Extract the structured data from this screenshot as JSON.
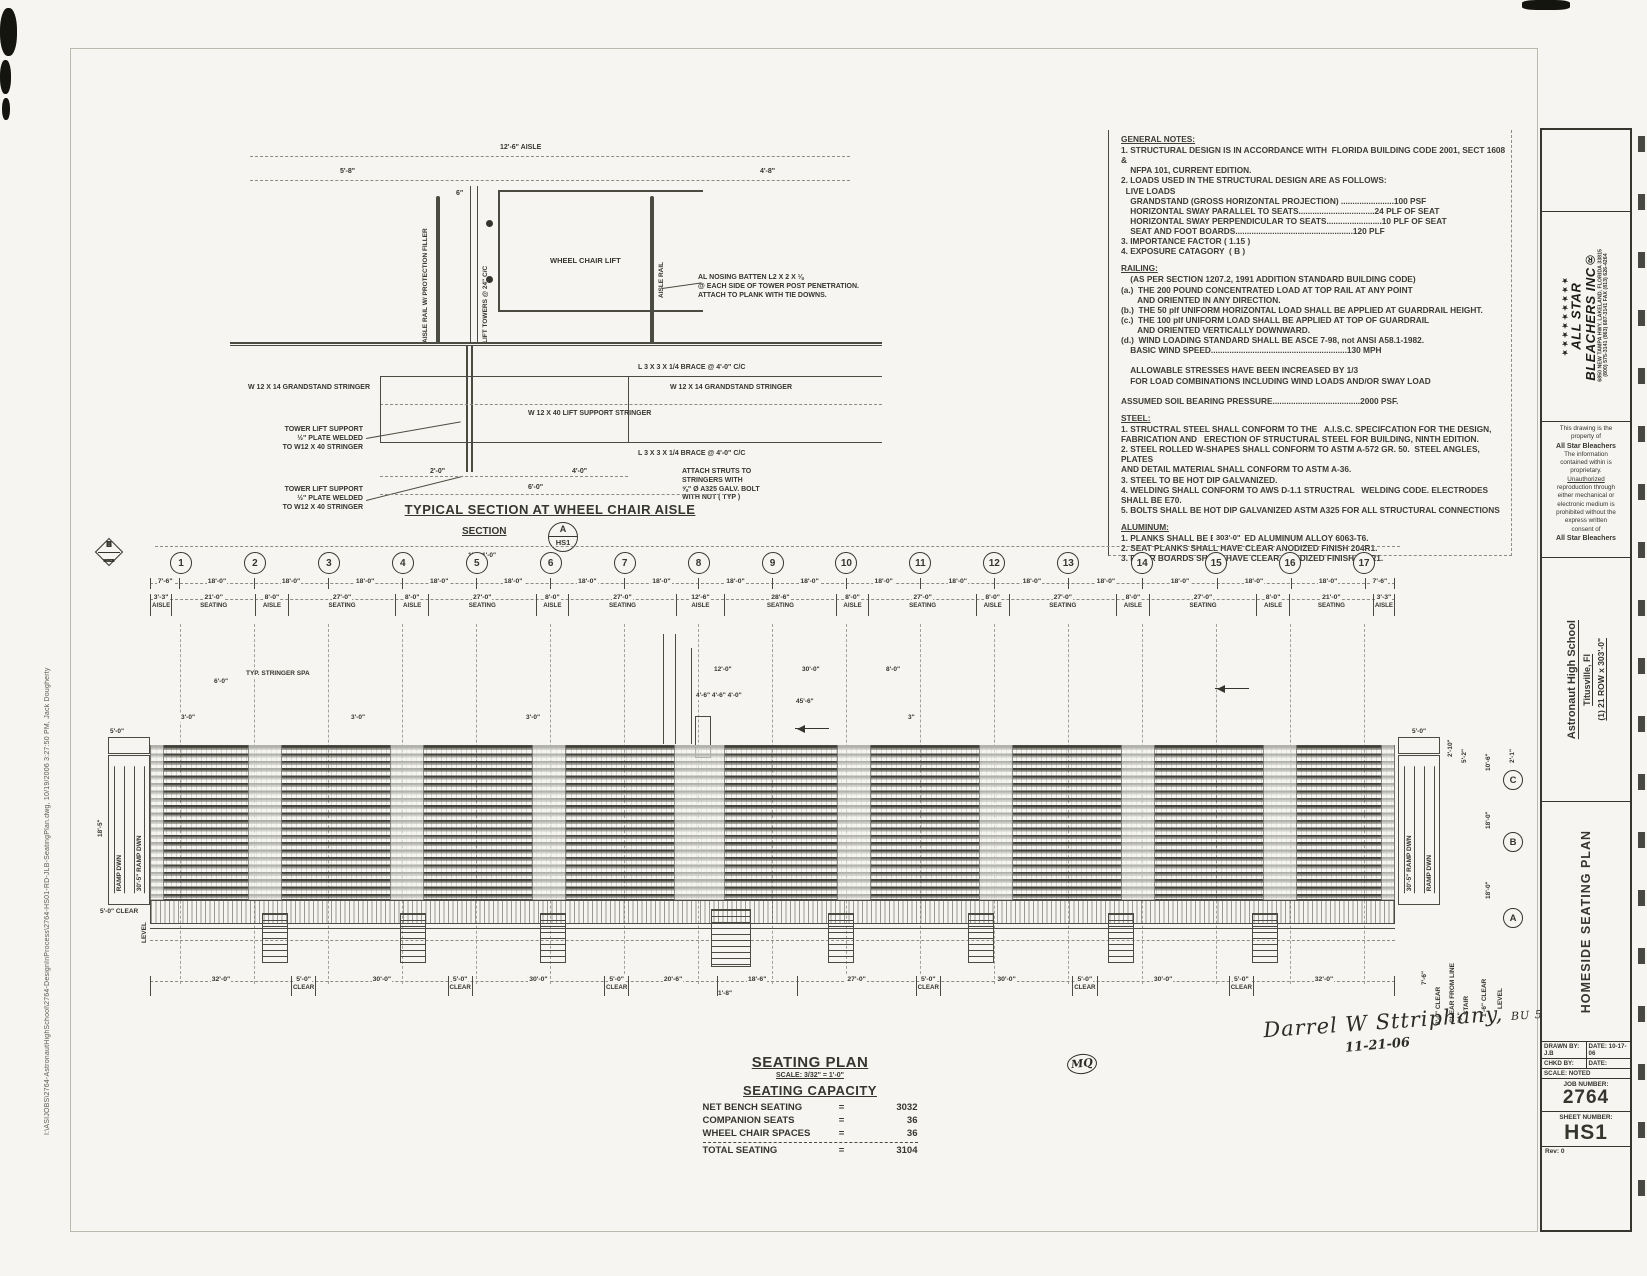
{
  "filepath": "I:\\ASIJOBS\\2764-AstronautHighSchool\\2764-DesignInProcess\\2764-HS01-RD-JLB-SeatingPlan.dwg, 10/19/2006 3:27:50 PM, Jack Dougherty",
  "notes": {
    "sections": [
      {
        "heading": "GENERAL NOTES:",
        "body": "1. STRUCTURAL DESIGN IS IN ACCORDANCE WITH  FLORIDA BUILDING CODE 2001, SECT 1608 &\n    NFPA 101, CURRENT EDITION.\n2. LOADS USED IN THE STRUCTURAL DESIGN ARE AS FOLLOWS:\n  LIVE LOADS\n    GRANDSTAND (GROSS HORIZONTAL PROJECTION) .......................100 PSF\n    HORIZONTAL SWAY PARALLEL TO SEATS.................................24 PLF OF SEAT\n    HORIZONTAL SWAY PERPENDICULAR TO SEATS........................10 PLF OF SEAT\n    SEAT AND FOOT BOARDS...................................................120 PLF\n3. IMPORTANCE FACTOR ( 1.15 )\n4. EXPOSURE CATAGORY  ( B )"
      },
      {
        "heading": "RAILING:",
        "body": "    (AS PER SECTION 1207.2, 1991 ADDITION STANDARD BUILDING CODE)\n(a.)  THE 200 POUND CONCENTRATED LOAD AT TOP RAIL AT ANY POINT\n       AND ORIENTED IN ANY DIRECTION.\n(b.)  THE 50 plf UNIFORM HORIZONTAL LOAD SHALL BE APPLIED AT GUARDRAIL HEIGHT.\n(c.)  THE 100 plf UNIFORM LOAD SHALL BE APPLIED AT TOP OF GUARDRAIL\n       AND ORIENTED VERTICALLY DOWNWARD.\n(d.)  WIND LOADING STANDARD SHALL BE ASCE 7-98, not ANSI A58.1-1982.\n    BASIC WIND SPEED...........................................................130 MPH\n\n    ALLOWABLE STRESSES HAVE BEEN INCREASED BY 1/3\n    FOR LOAD COMBINATIONS INCLUDING WIND LOADS AND/OR SWAY LOAD\n\nASSUMED SOIL BEARING PRESSURE......................................2000 PSF."
      },
      {
        "heading": "STEEL:",
        "body": "1. STRUCTRAL STEEL SHALL CONFORM TO THE   A.I.S.C. SPECIFCATION FOR THE DESIGN,\nFABRICATION AND   ERECTION OF STRUCTURAL STEEL FOR BUILDING, NINTH EDITION.\n2. STEEL ROLLED W-SHAPES SHALL CONFORM TO ASTM A-572 GR. 50.  STEEL ANGLES, PLATES\nAND DETAIL MATERIAL SHALL CONFORM TO ASTM A-36.\n3. STEEL TO BE HOT DIP GALVANIZED.\n4. WELDING SHALL CONFORM TO AWS D-1.1 STRUCTRAL   WELDING CODE. ELECTRODES SHALL BE E70.\n5. BOLTS SHALL BE HOT DIP GALVANIZED ASTM A325 FOR ALL STRUCTURAL CONNECTIONS"
      },
      {
        "heading": "ALUMINUM:",
        "body": "1. PLANKS SHALL BE EXTRUDED ALUMINUM ALLOY 6063-T6.\n2. SEAT PLANKS SHALL HAVE CLEAR ANODIZED FINISH 204R1.\n3. RISER BOARDS SHALL HAVE CLEAR ANODIZED FINISH 204R1."
      }
    ]
  },
  "detail": {
    "dim_aisle": "12'-6\" AISLE",
    "dim_left": "5'-8\"",
    "dim_right": "4'-8\"",
    "dim_small": "6\"",
    "rail_left": "AISLE RAIL W/ PROTECTION FILLER",
    "towers": "LIFT TOWERS  @ 24\" C/C",
    "rail_right": "AISLE RAIL",
    "lift": "WHEEL CHAIR LIFT",
    "nosing": "AL NOSING BATTEN L2 X 2 X ⅛\n@ EACH SIDE OF TOWER POST PENETRATION.\nATTACH TO PLANK WITH TIE DOWNS.",
    "grandstand_left": "W 12 X 14 GRANDSTAND STRINGER",
    "grandstand_right": "W 12 X 14 GRANDSTAND STRINGER",
    "brace_upper": "L 3 X 3 X 1/4  BRACE @ 4'-0\" C/C",
    "brace_lower": "L 3 X 3 X 1/4  BRACE @ 4'-0\" C/C",
    "lift_stringer": "W 12 X 40 LIFT SUPPORT STRINGER",
    "tower_support_1": "TOWER LIFT SUPPORT\n½\" PLATE WELDED\nTO W12 X 40 STRINGER",
    "tower_support_2": "TOWER LIFT SUPPORT\n½\" PLATE WELDED\nTO W12 X 40 STRINGER",
    "struts": "ATTACH STRUTS TO\nSTRINGERS WITH\n⅝\" Ø A325 GALV. BOLT\nWITH NUT ( TYP )",
    "dim_2": "2'-0\"",
    "dim_4": "4'-0\"",
    "dim_6": "6'-0\"",
    "title": "TYPICAL SECTION AT WHEEL CHAIR AISLE",
    "section_label": "SECTION",
    "bubble_top": "A",
    "bubble_bottom": "HS1",
    "scale": "1\" = 1'-0\""
  },
  "plan": {
    "overall_dim": "303'-0\"",
    "grids": [
      "1",
      "2",
      "3",
      "4",
      "5",
      "6",
      "7",
      "8",
      "9",
      "10",
      "11",
      "12",
      "13",
      "14",
      "15",
      "16",
      "17"
    ],
    "grid_dims": [
      "7'-6\"",
      "18'-0\"",
      "18'-0\"",
      "18'-0\"",
      "18'-0\"",
      "18'-0\"",
      "18'-0\"",
      "18'-0\"",
      "18'-0\"",
      "18'-0\"",
      "18'-0\"",
      "18'-0\"",
      "18'-0\"",
      "18'-0\"",
      "18'-0\"",
      "18'-0\"",
      "18'-0\"",
      "7'-6\""
    ],
    "bays": [
      {
        "dim": "3'-3\"",
        "label": "AISLE"
      },
      {
        "dim": "21'-0\"",
        "label": "SEATING"
      },
      {
        "dim": "8'-0\"",
        "label": "AISLE"
      },
      {
        "dim": "27'-0\"",
        "label": "SEATING"
      },
      {
        "dim": "8'-0\"",
        "label": "AISLE"
      },
      {
        "dim": "27'-0\"",
        "label": "SEATING"
      },
      {
        "dim": "8'-0\"",
        "label": "AISLE"
      },
      {
        "dim": "27'-0\"",
        "label": "SEATING"
      },
      {
        "dim": "12'-6\"",
        "label": "AISLE"
      },
      {
        "dim": "28'-6\"",
        "label": "SEATING"
      },
      {
        "dim": "8'-0\"",
        "label": "AISLE"
      },
      {
        "dim": "27'-0\"",
        "label": "SEATING"
      },
      {
        "dim": "8'-0\"",
        "label": "AISLE"
      },
      {
        "dim": "27'-0\"",
        "label": "SEATING"
      },
      {
        "dim": "8'-0\"",
        "label": "AISLE"
      },
      {
        "dim": "27'-0\"",
        "label": "SEATING"
      },
      {
        "dim": "8'-0\"",
        "label": "AISLE"
      },
      {
        "dim": "21'-0\"",
        "label": "SEATING"
      },
      {
        "dim": "3'-3\"",
        "label": "AISLE"
      }
    ],
    "bottom_dims": [
      {
        "dim": "32'-0\"",
        "label": ""
      },
      {
        "dim": "5'-0\"",
        "label": "CLEAR"
      },
      {
        "dim": "30'-0\"",
        "label": ""
      },
      {
        "dim": "5'-0\"",
        "label": "CLEAR"
      },
      {
        "dim": "30'-0\"",
        "label": ""
      },
      {
        "dim": "5'-0\"",
        "label": "CLEAR"
      },
      {
        "dim": "20'-6\"",
        "label": ""
      },
      {
        "dim": "18'-6\"",
        "label": ""
      },
      {
        "dim": "27'-0\"",
        "label": ""
      },
      {
        "dim": "5'-0\"",
        "label": "CLEAR"
      },
      {
        "dim": "30'-0\"",
        "label": ""
      },
      {
        "dim": "5'-0\"",
        "label": "CLEAR"
      },
      {
        "dim": "30'-0\"",
        "label": ""
      },
      {
        "dim": "5'-0\"",
        "label": "CLEAR"
      },
      {
        "dim": "32'-0\"",
        "label": ""
      }
    ],
    "markers": [
      {
        "letter": "E",
        "sheet": "HS11"
      },
      {
        "letter": "D",
        "sheet": "HS10"
      },
      {
        "letter": "C",
        "sheet": "HS3"
      },
      {
        "letter": "B",
        "sheet": "HS1"
      },
      {
        "letter": "A",
        "sheet": "HS1"
      }
    ],
    "rows": [
      {
        "letter": "C",
        "dim": "10'-6\""
      },
      {
        "letter": "B",
        "dim": "18'-0\""
      },
      {
        "letter": "A",
        "dim": "18'-0\""
      }
    ],
    "left_end": {
      "ramp": "RAMP DWN",
      "ramp_inner": "30'-5\" RAMP DWN",
      "dim_top": "5'-0\"",
      "dim_side": "18'-5\"",
      "clear": "5'-0\" CLEAR",
      "level": "LEVEL"
    },
    "right_end": {
      "ramp": "RAMP DWN",
      "ramp_inner": "30'-5\" RAMP DWN",
      "dim_top": "5'-0\"",
      "dim_a": "2'-10\"",
      "dim_b": "5'-2\"",
      "clear": "1'-6\" CLEAR",
      "level": "LEVEL",
      "clear_line": "CLEAR FROM LINE \"A\"",
      "stair": "STAIR",
      "clear3": "3'-0\" CLEAR",
      "dim_c": "7'-6\"",
      "dim_d": "2'-1\""
    },
    "center": {
      "d12": "12'-0\"",
      "d30": "30'-0\"",
      "d8": "8'-0\"",
      "d44": "4'-6\"  4'-6\"  4'-0\"",
      "d456": "45'-6\"",
      "d3": "3\"",
      "d18": "1'-8\""
    },
    "typ_stringer": "TYP. STRINGER SPA",
    "typ_dim": "6'-0\"",
    "d30_small": "3'-0\"",
    "title": "SEATING PLAN",
    "scale": "SCALE: 3/32\" = 1'-0\"",
    "capacity": {
      "title": "SEATING CAPACITY",
      "rows": [
        {
          "name": "NET BENCH SEATING",
          "eq": "=",
          "value": "3032"
        },
        {
          "name": "COMPANION SEATS",
          "eq": "=",
          "value": "36"
        },
        {
          "name": "WHEEL CHAIR SPACES",
          "eq": "=",
          "value": "36"
        }
      ],
      "total": {
        "name": "TOTAL SEATING",
        "eq": "=",
        "value": "3104"
      }
    }
  },
  "signature": {
    "name": "Darrel W Sttriphany,",
    "tag": "BU 518",
    "date": "11-21-06",
    "initials": "MQ"
  },
  "titleblock": {
    "logo": {
      "stars": "★★★★★★★★★",
      "main": "ALL STAR",
      "main2": "BLEACHERS INC®",
      "address": "6850 NEW TAMPA HWY.  LAKELAND, FLORIDA 33815",
      "phones": "(800) 575-3141   (863) 687-3141   FAX (813) 626-4264"
    },
    "proprietary": [
      "This drawing is the",
      "property of",
      "All Star Bleachers",
      "The information",
      "contained within is",
      "proprietary.",
      "Unauthorized",
      "reproduction through",
      "either mechanical or",
      "electronic medium is",
      "prohibited without the",
      "express written",
      "consent of",
      "All Star Bleachers"
    ],
    "project": {
      "name": "Astronaut High School",
      "city": "Titusville, Fl",
      "config": "(1) 21 ROW x 303'-0\""
    },
    "sheet_title": "HOMESIDE SEATING PLAN",
    "fields": {
      "drawn_by": "DRAWN BY: J.B",
      "date1": "DATE: 10-17-06",
      "chkd_by": "CHKD BY:",
      "date2": "DATE:",
      "scale": "SCALE: NOTED",
      "job_label": "JOB NUMBER:",
      "job_number": "2764",
      "sheet_label": "SHEET NUMBER:",
      "sheet_number": "HS1",
      "rev": "Rev: 0"
    }
  }
}
